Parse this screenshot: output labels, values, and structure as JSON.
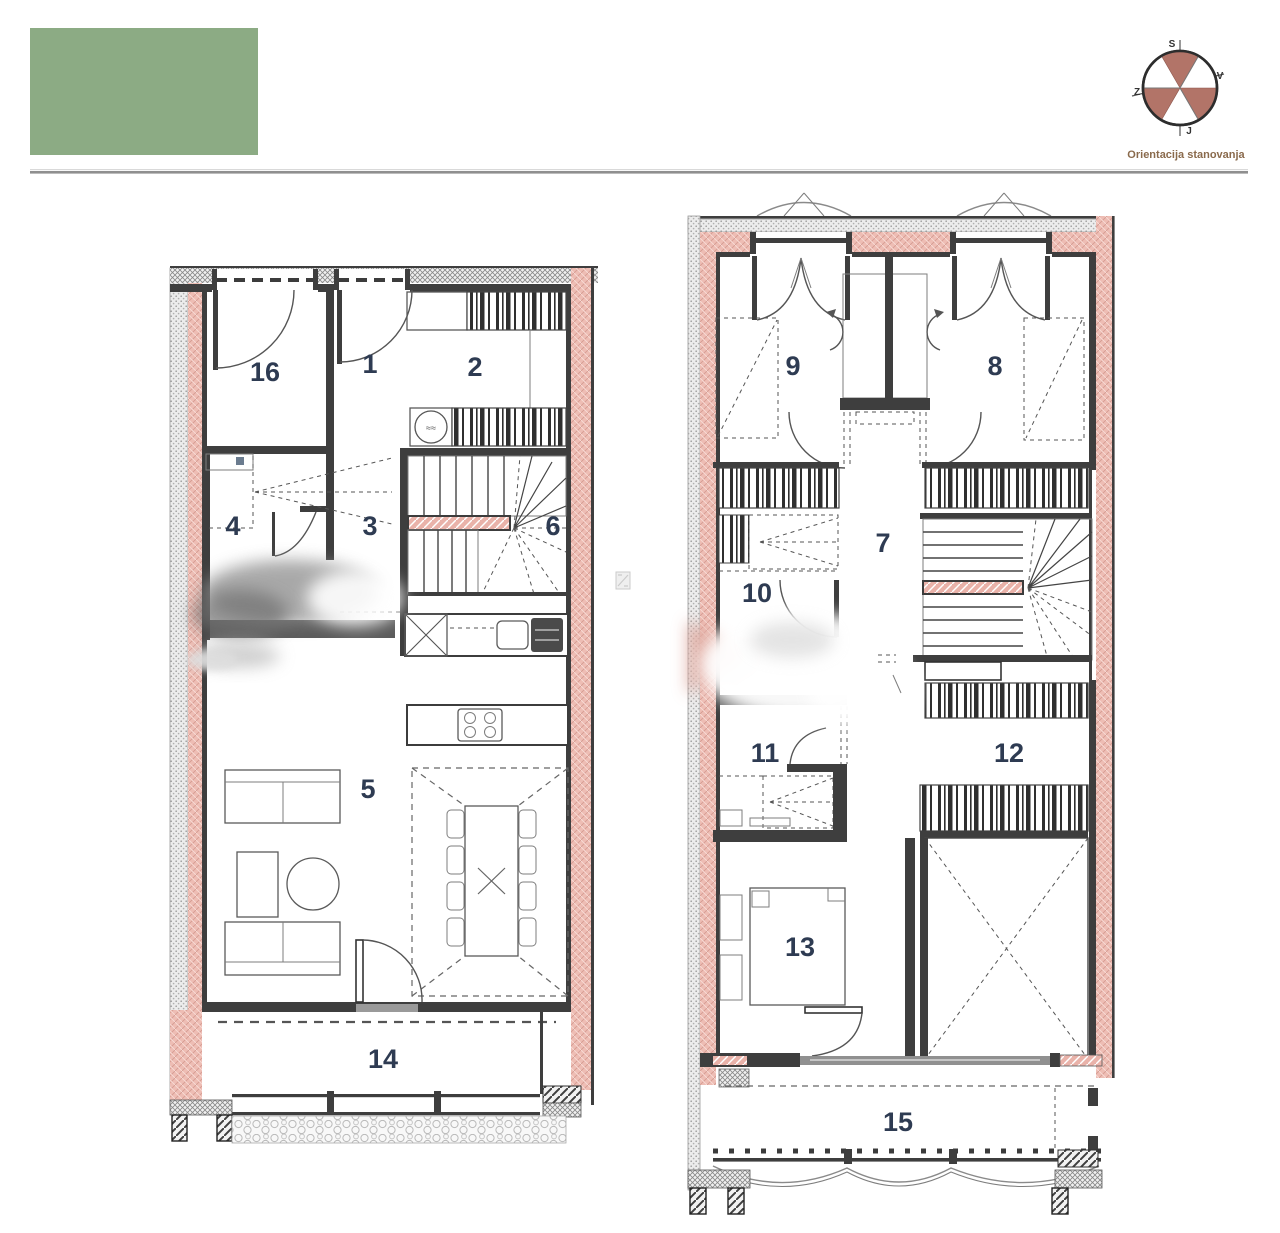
{
  "header": {
    "logo_color": "#8CAB84"
  },
  "compass": {
    "caption": "Orientacija stanovanja",
    "north": "S",
    "east": "V",
    "south": "J",
    "west": "Z"
  },
  "plans": {
    "left": {
      "rooms": [
        {
          "number": "16"
        },
        {
          "number": "1"
        },
        {
          "number": "2"
        },
        {
          "number": "4"
        },
        {
          "number": "3"
        },
        {
          "number": "6"
        },
        {
          "number": "5"
        },
        {
          "number": "14"
        }
      ]
    },
    "right": {
      "rooms": [
        {
          "number": "9"
        },
        {
          "number": "8"
        },
        {
          "number": "10"
        },
        {
          "number": "7"
        },
        {
          "number": "11"
        },
        {
          "number": "12"
        },
        {
          "number": "13"
        },
        {
          "number": "15"
        }
      ]
    }
  }
}
